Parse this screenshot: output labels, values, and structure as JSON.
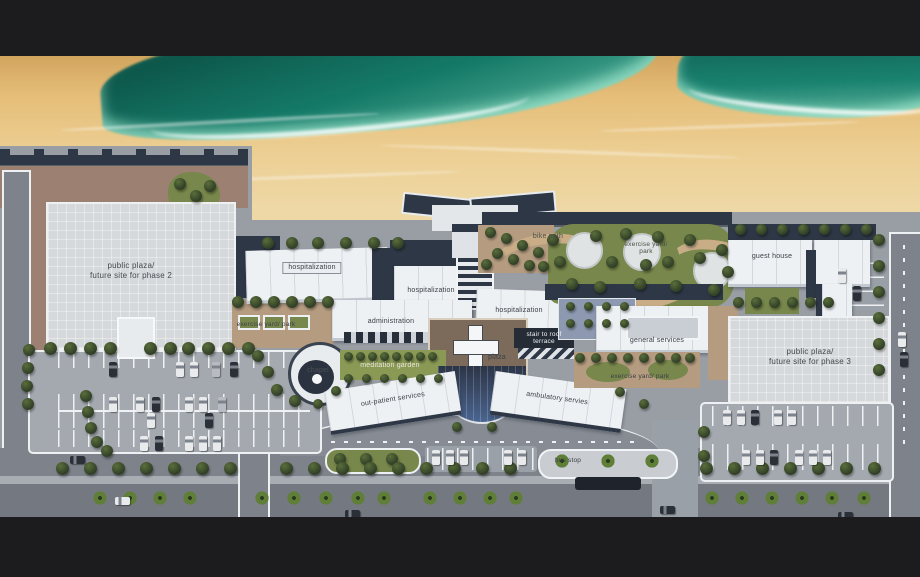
{
  "labels": {
    "phase2": "public plaza/\nfuture site for phase 2",
    "hospitalization_1": "hospitalization",
    "hospitalization_2": "hospitalization",
    "hospitalization_3": "hospitalization",
    "administration": "administration",
    "exercise_yard_left": "exercise yard/ park",
    "chapel": "chapel",
    "meditation_garden": "meditation garden",
    "stair_to_roof": "stair to roof\nterrace",
    "plaza": "plaza",
    "bike_path": "bike path",
    "exercise_yard_top": "exercise yard/\npark",
    "general_services": "general services",
    "exercise_yard_right": "exercise yard/ park",
    "guest_house": "guest house",
    "phase3": "public plaza/\nfuture site for phase 3",
    "out_patient": "out-patient services",
    "ambulatory": "ambulatory servies",
    "bus_stop": "bus stop"
  },
  "palette": {
    "letterbox": "#1c1c1e",
    "ocean_deep": "#0c5246",
    "ocean_foam": "#9ddcc6",
    "sand": "#ecce92",
    "ground_gray": "#999ea5",
    "road_gray": "#7e838b",
    "plaza_gray": "#d6d9db",
    "terracotta": "#9c8173",
    "tan_path": "#b59c80",
    "lawn_green": "#78874b",
    "tree_green": "#36452a",
    "roof_white": "#eef1f4",
    "roof_navy": "#2e3745",
    "glass_blue": "#4a6590"
  }
}
